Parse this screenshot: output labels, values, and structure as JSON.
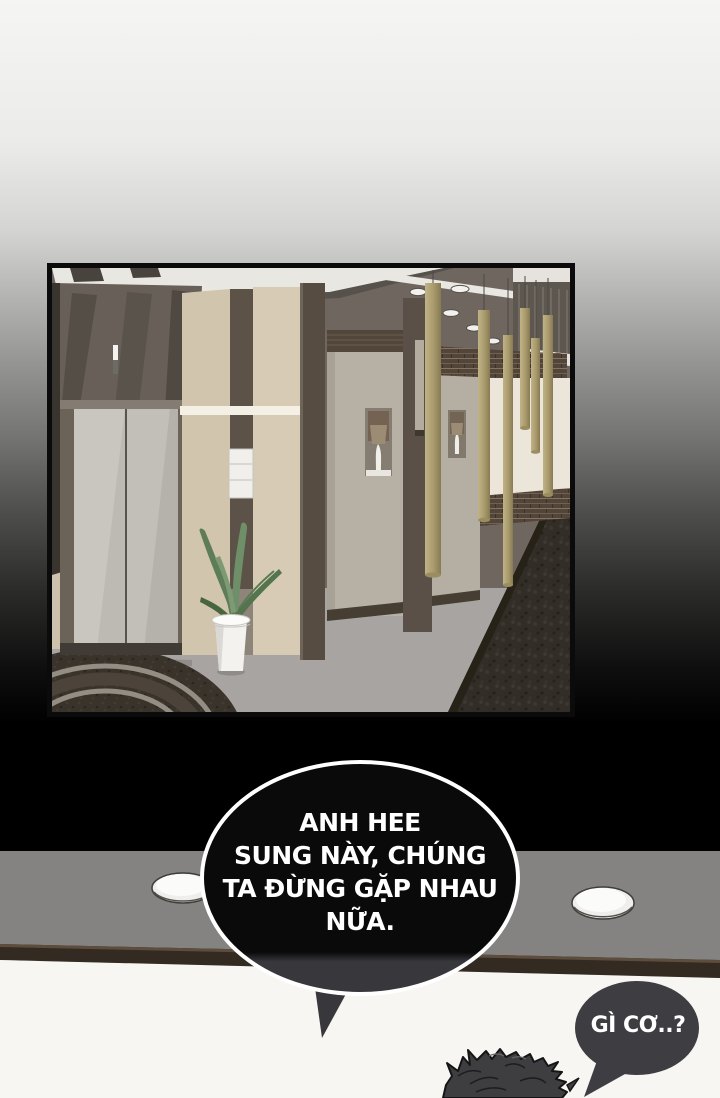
{
  "page": {
    "type": "comic-page",
    "background_top_color": "#f5f5f4",
    "background_bottom_color": "#000000"
  },
  "panel": {
    "description": "3d-rendered-hotel-hallway-with-elevator-plant-and-hanging-lamps",
    "frame_color": "#0b0b0b"
  },
  "lower_panel": {
    "description": "ceiling-with-two-recessed-dome-lights-and-dark-beam",
    "ceiling_color": "#858282",
    "beam_color": "#332a21",
    "wall_color": "#f8f6f3"
  },
  "bubbles": {
    "main": {
      "lines": [
        "ANH HEE",
        "SUNG NÀY, CHÚNG",
        "TA ĐỪNG GẶP NHAU",
        "NỮA."
      ],
      "fill_color": "#0a0a0a",
      "lower_fill_color": "#38383c",
      "border_color": "#ffffff",
      "text_color": "#ffffff"
    },
    "reply": {
      "text": "GÌ CƠ..?",
      "fill_color": "#3e3d42",
      "text_color": "#ffffff"
    }
  },
  "character": {
    "description": "spiky-dark-hair-top-of-head",
    "hair_color": "#3e3d3f"
  }
}
